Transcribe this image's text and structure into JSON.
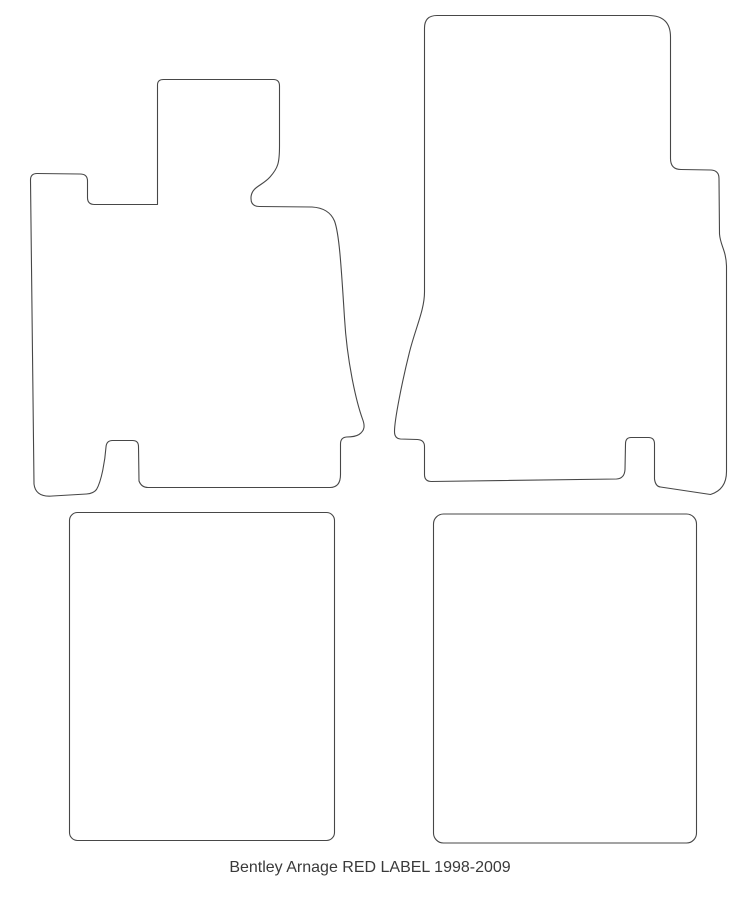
{
  "caption": "Bentley Arnage RED LABEL 1998-2009",
  "colors": {
    "outline": "#474747",
    "background": "#ffffff",
    "caption_text": "#3a3a3a"
  },
  "shapes": {
    "front_left": "front-left-mat-outline",
    "front_right": "front-right-mat-outline",
    "rear_left": "rear-left-mat-outline",
    "rear_right": "rear-right-mat-outline"
  }
}
